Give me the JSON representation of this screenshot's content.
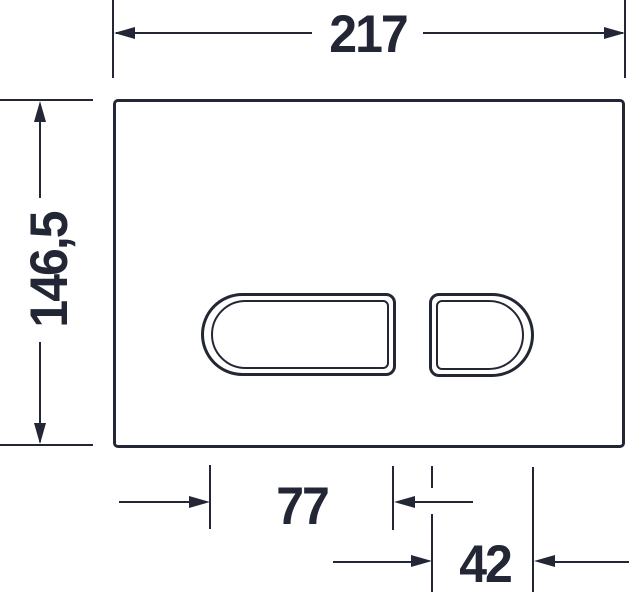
{
  "drawing": {
    "type": "technical-dimension-drawing",
    "subject": "flush-actuator-plate front view with two flush buttons"
  },
  "colors": {
    "line": "#232735",
    "background": "#ffffff"
  },
  "dimensions": {
    "overall_width": "217",
    "overall_height": "146,5",
    "large_button_width": "77",
    "small_button_width": "42"
  }
}
